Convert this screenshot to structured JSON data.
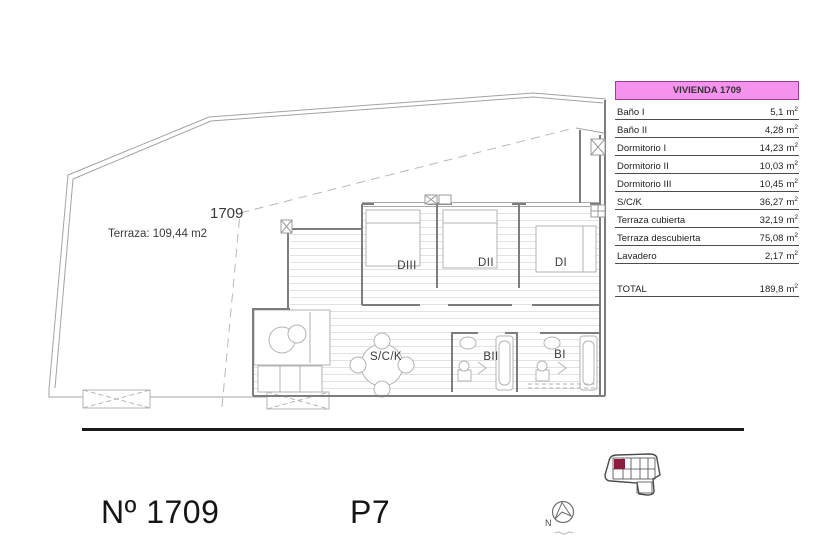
{
  "colors": {
    "table-header-bg": "#f592ee",
    "table-header-border": "#9c3d9c",
    "unit-red": "#c13530",
    "keyplan-highlight": "#8c1d3f",
    "separator": "#1a1a1a"
  },
  "plan": {
    "unit_label": "1709",
    "terrace_label": "Terraza: 109,44 m2",
    "rooms": {
      "dormitorio3": "DIII",
      "dormitorio2": "DII",
      "dormitorio1": "DI",
      "salon_cocina": "S/C/K",
      "bano2": "BII",
      "bano1": "BI"
    }
  },
  "table": {
    "header": "VIVIENDA 1709",
    "unit": "m",
    "unit_sup": "2",
    "rows": [
      {
        "label": "Baño I",
        "value": "5,1"
      },
      {
        "label": "Baño II",
        "value": "4,28"
      },
      {
        "label": "Dormitorio I",
        "value": "14,23"
      },
      {
        "label": "Dormitorio II",
        "value": "10,03"
      },
      {
        "label": "Dormitorio III",
        "value": "10,45"
      },
      {
        "label": "S/C/K",
        "value": "36,27"
      },
      {
        "label": "Terraza cubierta",
        "value": "32,19"
      },
      {
        "label": "Terraza descubierta",
        "value": "75,08"
      },
      {
        "label": "Lavadero",
        "value": "2,17"
      }
    ],
    "total_label": "TOTAL",
    "total_value": "189,8"
  },
  "footer": {
    "unit_number": "Nº 1709",
    "floor": "P7",
    "compass_n": "N"
  }
}
